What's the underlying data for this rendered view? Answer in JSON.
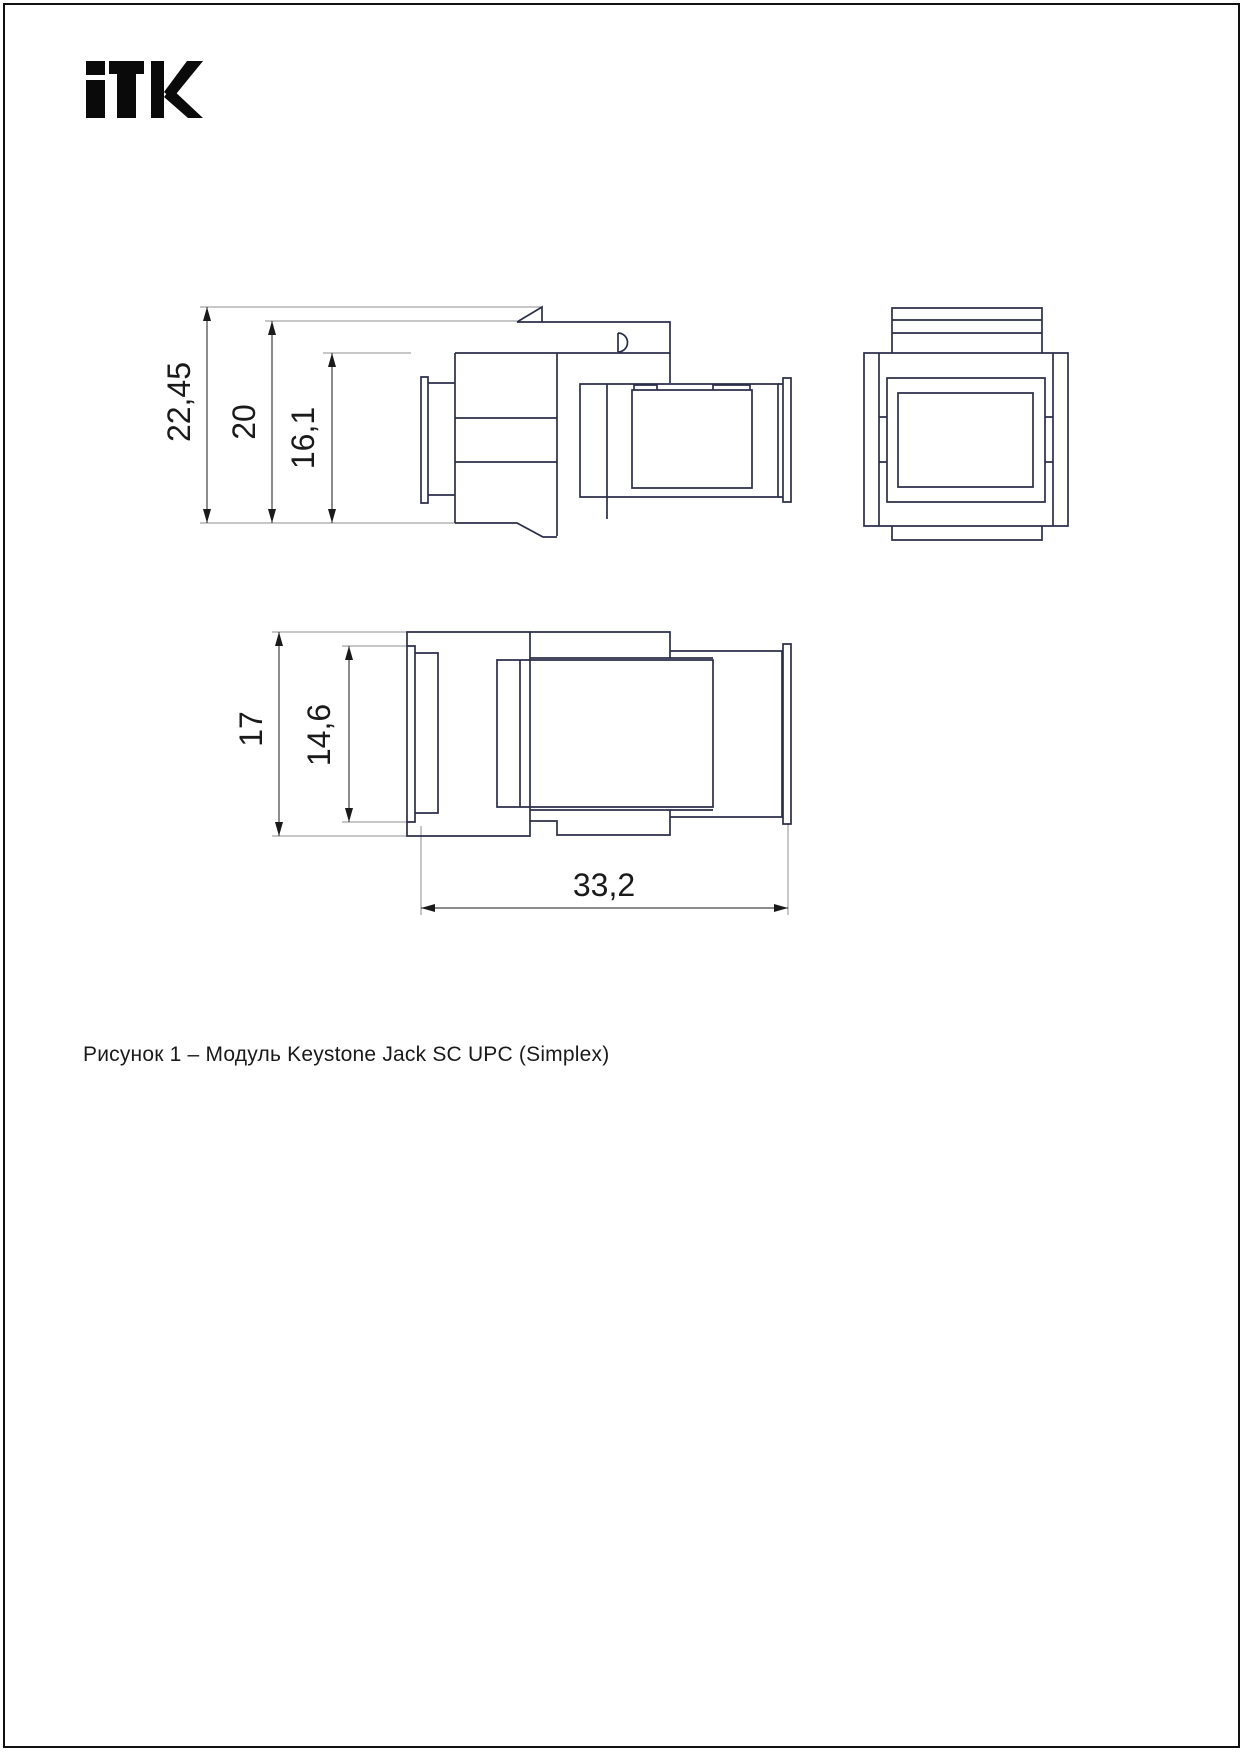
{
  "page": {
    "background_color": "#ffffff",
    "border_color": "#111111"
  },
  "logo": {
    "text": "iTK",
    "color": "#0a0a0a"
  },
  "drawing": {
    "line_color": "#2b2e4a",
    "dimension_color": "#1a1a1a",
    "extension_color": "#8f8f93",
    "side_view": {
      "overall_height": "22,45",
      "latch_height": "20",
      "body_height": "16,1"
    },
    "top_view": {
      "overall_width": "17",
      "inner_width": "14,6",
      "length": "33,2"
    }
  },
  "caption": {
    "text": "Рисунок 1 – Модуль Keystone Jack SC UPC (Simplex)"
  }
}
